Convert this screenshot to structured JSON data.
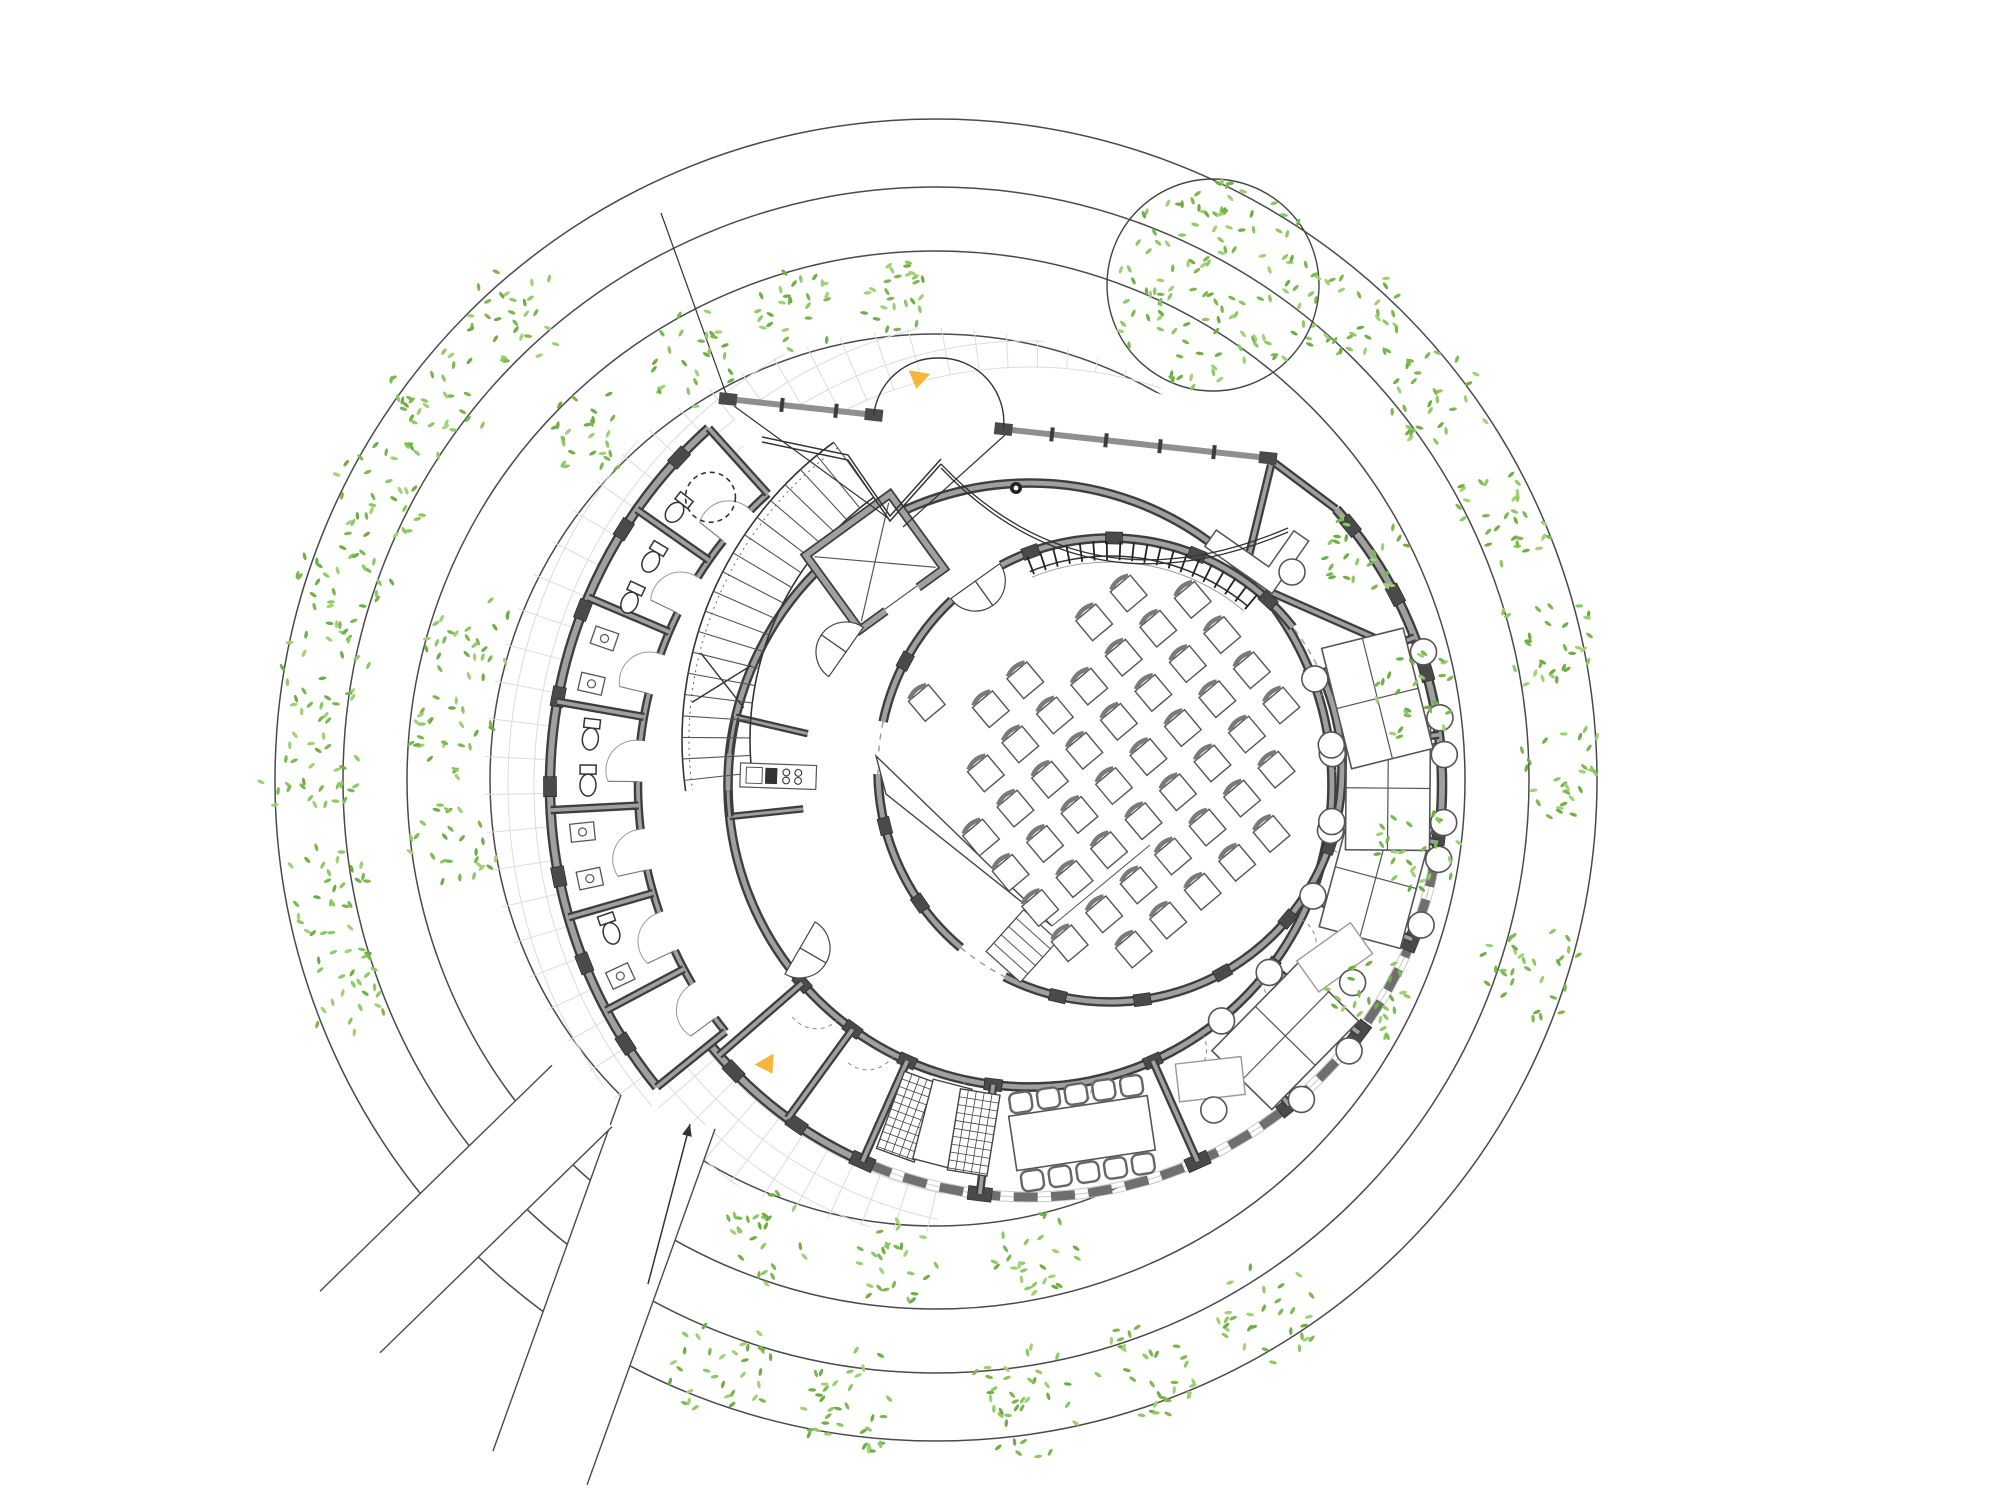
{
  "drawing_type": "architectural-floor-plan",
  "colors": {
    "background": "#ffffff",
    "site_line": "#4a4a4a",
    "grid_line": "#dcdcdc",
    "wall_core": "#a0a0a0",
    "wall_edge": "#3e3e3e",
    "pier": "#4a4a4a",
    "glazing_dash": "#6f6f6f",
    "glazing_track": "#c9c9c9",
    "furniture": "#555555",
    "furniture_light": "#8a8a8a",
    "thin_line": "#333333",
    "leaf_greens": [
      "#8dc963",
      "#7db84f",
      "#9ed274",
      "#6fae43"
    ],
    "entry_marker": "#f6b63c"
  },
  "site": {
    "center": [
      936,
      780
    ],
    "band_circles": [
      446,
      529,
      593,
      661
    ],
    "big_tree": {
      "cx": 1213,
      "cy": 285,
      "r": 106,
      "leaves": 300
    },
    "trees": [
      [
        625,
        132,
        74
      ],
      [
        625,
        143,
        80
      ],
      [
        625,
        152,
        74
      ],
      [
        625,
        161,
        76
      ],
      [
        625,
        170,
        72
      ],
      [
        625,
        180,
        74
      ],
      [
        625,
        190,
        72
      ],
      [
        625,
        200,
        66
      ],
      [
        628,
        250,
        82
      ],
      [
        628,
        262,
        86
      ],
      [
        628,
        278,
        86
      ],
      [
        628,
        290,
        80
      ],
      [
        630,
        302,
        76
      ],
      [
        625,
        342,
        76
      ],
      [
        625,
        1,
        72
      ],
      [
        625,
        13,
        74
      ],
      [
        625,
        25,
        76
      ],
      [
        625,
        37,
        80
      ],
      [
        625,
        48,
        82
      ],
      [
        487,
        95,
        46
      ],
      [
        487,
        107,
        60
      ],
      [
        487,
        120,
        70
      ],
      [
        487,
        135,
        62
      ],
      [
        488,
        163,
        62
      ],
      [
        488,
        175,
        60
      ],
      [
        487,
        188,
        62
      ],
      [
        488,
        250,
        64
      ],
      [
        487,
        265,
        62
      ],
      [
        487,
        282,
        60
      ],
      [
        487,
        333,
        62
      ],
      [
        487,
        352,
        60
      ],
      [
        487,
        10,
        62
      ],
      [
        487,
        28,
        60
      ]
    ],
    "leaf_density": 0.011,
    "paths": [
      {
        "p0": [
          668,
          1112
        ],
        "p1": [
          540,
          1468
        ],
        "width": 100
      },
      {
        "p0": [
          582,
          1096
        ],
        "p1": [
          350,
          1322
        ],
        "width": 86
      }
    ],
    "approach_arrow": {
      "from": [
        648,
        1284
      ],
      "to": [
        690,
        1124
      ]
    }
  },
  "plaza_grid": {
    "center": [
      1030,
      785
    ],
    "r_in": 418,
    "r_out": 642,
    "a0": 25,
    "a1": 258,
    "arc_step": 26,
    "ray_step": 4,
    "clip_circle": {
      "cx": 936,
      "cy": 780,
      "r": 452
    },
    "edge_line": [
      [
        661,
        213
      ],
      [
        728,
        399
      ]
    ]
  },
  "building": {
    "center": [
      1030,
      785
    ],
    "main_wall": {
      "r": 412,
      "solid_spans": [
        [
          219,
          246
        ],
        [
          348,
          402
        ]
      ],
      "glazed_span": [
        246,
        348
      ]
    },
    "annex_wall": {
      "r_out": 480,
      "r_in": 392,
      "a0": 132,
      "a1": 219,
      "door_angles": [
        138.5,
        151,
        163.5,
        176.5,
        189.5,
        202,
        213.5
      ]
    },
    "inner_ring_wall": {
      "r": 302,
      "a0": 221,
      "a1": 381,
      "door_angles": [
        227.5,
        240,
        254.5,
        278.5,
        301.5,
        316,
        330.5,
        345,
        359.5,
        14
      ]
    },
    "partitions_main": [
      221,
      234,
      246,
      263,
      294,
      309,
      323,
      338,
      352,
      7,
      21
    ],
    "partitions_annex": [
      132,
      145,
      157,
      170,
      183,
      196,
      208,
      219
    ],
    "kitchen": {
      "a0": 167,
      "a1": 186,
      "r_in": 228,
      "r_out": 302
    },
    "facade": {
      "f1": [
        728,
        399
      ],
      "f2": [
        1268,
        458
      ],
      "door_s": 0.27,
      "door_e": 0.51,
      "mullions": 9
    },
    "foyer": {
      "quad": [
        [
          728,
          399
        ],
        [
          1268,
          458
        ],
        [
          1336,
          509
        ],
        [
          754,
          479
        ]
      ],
      "zigzag": [
        [
          762,
          442
        ],
        [
          848,
          460
        ],
        [
          890,
          521
        ],
        [
          941,
          464
        ]
      ],
      "diagonals": [
        [
          [
            734,
            406
          ],
          [
            888,
            518
          ]
        ],
        [
          [
            1005,
            435
          ],
          [
            903,
            527
          ]
        ]
      ],
      "canopy": {
        "from": [
          941,
          464
        ],
        "ctrl": [
          1085,
          615
        ],
        "to": [
          1288,
          528
        ]
      },
      "column_dot": [
        1016,
        488
      ]
    },
    "reception": {
      "walls": [
        [
          [
            1268,
            458
          ],
          [
            1336,
            509
          ]
        ],
        [
          [
            1271,
            465
          ],
          [
            1243,
            580
          ]
        ],
        [
          [
            1243,
            580
          ],
          [
            1402,
            650
          ]
        ]
      ],
      "desk": {
        "at": [
          1262,
          545
        ],
        "rot": -55
      },
      "chair": [
        1292,
        572
      ]
    },
    "entry_markers": [
      {
        "at": [
          918,
          380
        ],
        "rot": 10
      },
      {
        "at": [
          768,
          1066
        ],
        "rot": -30
      }
    ]
  },
  "core": {
    "stair": {
      "center": [
        1050,
        740
      ],
      "r_in": 300,
      "r_out": 368,
      "a0": 126,
      "a1": 188,
      "tread_step": 3.35,
      "break_a": 170
    },
    "elevator": {
      "at": [
        875,
        562
      ],
      "rot": -36,
      "w": 104,
      "h": 92
    }
  },
  "auditorium": {
    "center": [
      1110,
      770
    ],
    "r": 232,
    "gaps": [
      [
        118,
        133
      ],
      [
        168,
        181
      ],
      [
        230,
        243
      ],
      [
        24,
        38
      ]
    ],
    "dashed_gaps": [
      [
        230,
        243
      ],
      [
        24,
        38
      ],
      [
        168,
        181
      ]
    ],
    "pier_step": 21,
    "rail": {
      "r": 214,
      "a0": 50,
      "a1": 112,
      "tick_step": 3.4,
      "tick_out": 15
    },
    "chairs": {
      "cols": 11,
      "rows": 9,
      "su": 45,
      "sv": 46,
      "rot": -40,
      "offset": [
        4,
        16
      ],
      "size": 26,
      "clip_r": 196,
      "cut_sectors": [
        [
          100,
          150,
          128
        ],
        [
          160,
          235,
          148
        ]
      ]
    },
    "ramp": [
      [
        876,
        756
      ],
      [
        886,
        794
      ],
      [
        1052,
        926
      ]
    ],
    "hall_stair": {
      "at": [
        1022,
        946
      ],
      "rot": -48,
      "w": 56,
      "h": 46,
      "treads": 5,
      "guide_to": [
        1150,
        845
      ]
    }
  },
  "furniture": {
    "desk_clusters": [
      {
        "a": 315.5,
        "r": 358
      },
      {
        "a": 345,
        "r": 358
      },
      {
        "a": 359.5,
        "r": 358
      },
      {
        "a": 14,
        "r": 358
      }
    ],
    "single_desks": [
      {
        "a": 301.5,
        "r": 345
      },
      {
        "a": 330.5,
        "r": 350
      }
    ],
    "meeting_table": {
      "a": 278.5,
      "r": 352,
      "w": 140,
      "h": 55,
      "chairs_per_side": 5
    },
    "storage_units": [
      {
        "a": 250,
        "r": 353,
        "hatch": true
      },
      {
        "a": 255.5,
        "r": 350,
        "hatch": false
      },
      {
        "a": 260.8,
        "r": 352,
        "hatch": true
      }
    ],
    "wc_rooms": [
      {
        "type": "toilet",
        "a": 142,
        "r": 448
      },
      {
        "type": "toilet",
        "a": 149,
        "r": 440
      },
      {
        "type": "toilet",
        "a": 155,
        "r": 440
      },
      {
        "type": "sink",
        "a": 161,
        "r": 450
      },
      {
        "type": "sink",
        "a": 167,
        "r": 450
      },
      {
        "type": "toilet",
        "a": 173.5,
        "r": 442
      },
      {
        "type": "toilet",
        "a": 179.5,
        "r": 442
      },
      {
        "type": "sink",
        "a": 186,
        "r": 450
      },
      {
        "type": "sink",
        "a": 192,
        "r": 450
      },
      {
        "type": "toilet",
        "a": 199,
        "r": 444
      },
      {
        "type": "sink",
        "a": 205,
        "r": 452
      }
    ],
    "accessible_circle": {
      "a": 138,
      "r": 430,
      "rad": 25
    },
    "kitchen_counter": {
      "a": 178,
      "r": 252
    },
    "door_petals": [
      {
        "at_mode": "aud",
        "a": 125.5
      },
      {
        "at_mode": "point",
        "p": [
          800,
          948
        ],
        "rot": 120
      },
      {
        "at_mode": "point",
        "p": [
          846,
          652
        ],
        "rot": -55
      }
    ]
  }
}
